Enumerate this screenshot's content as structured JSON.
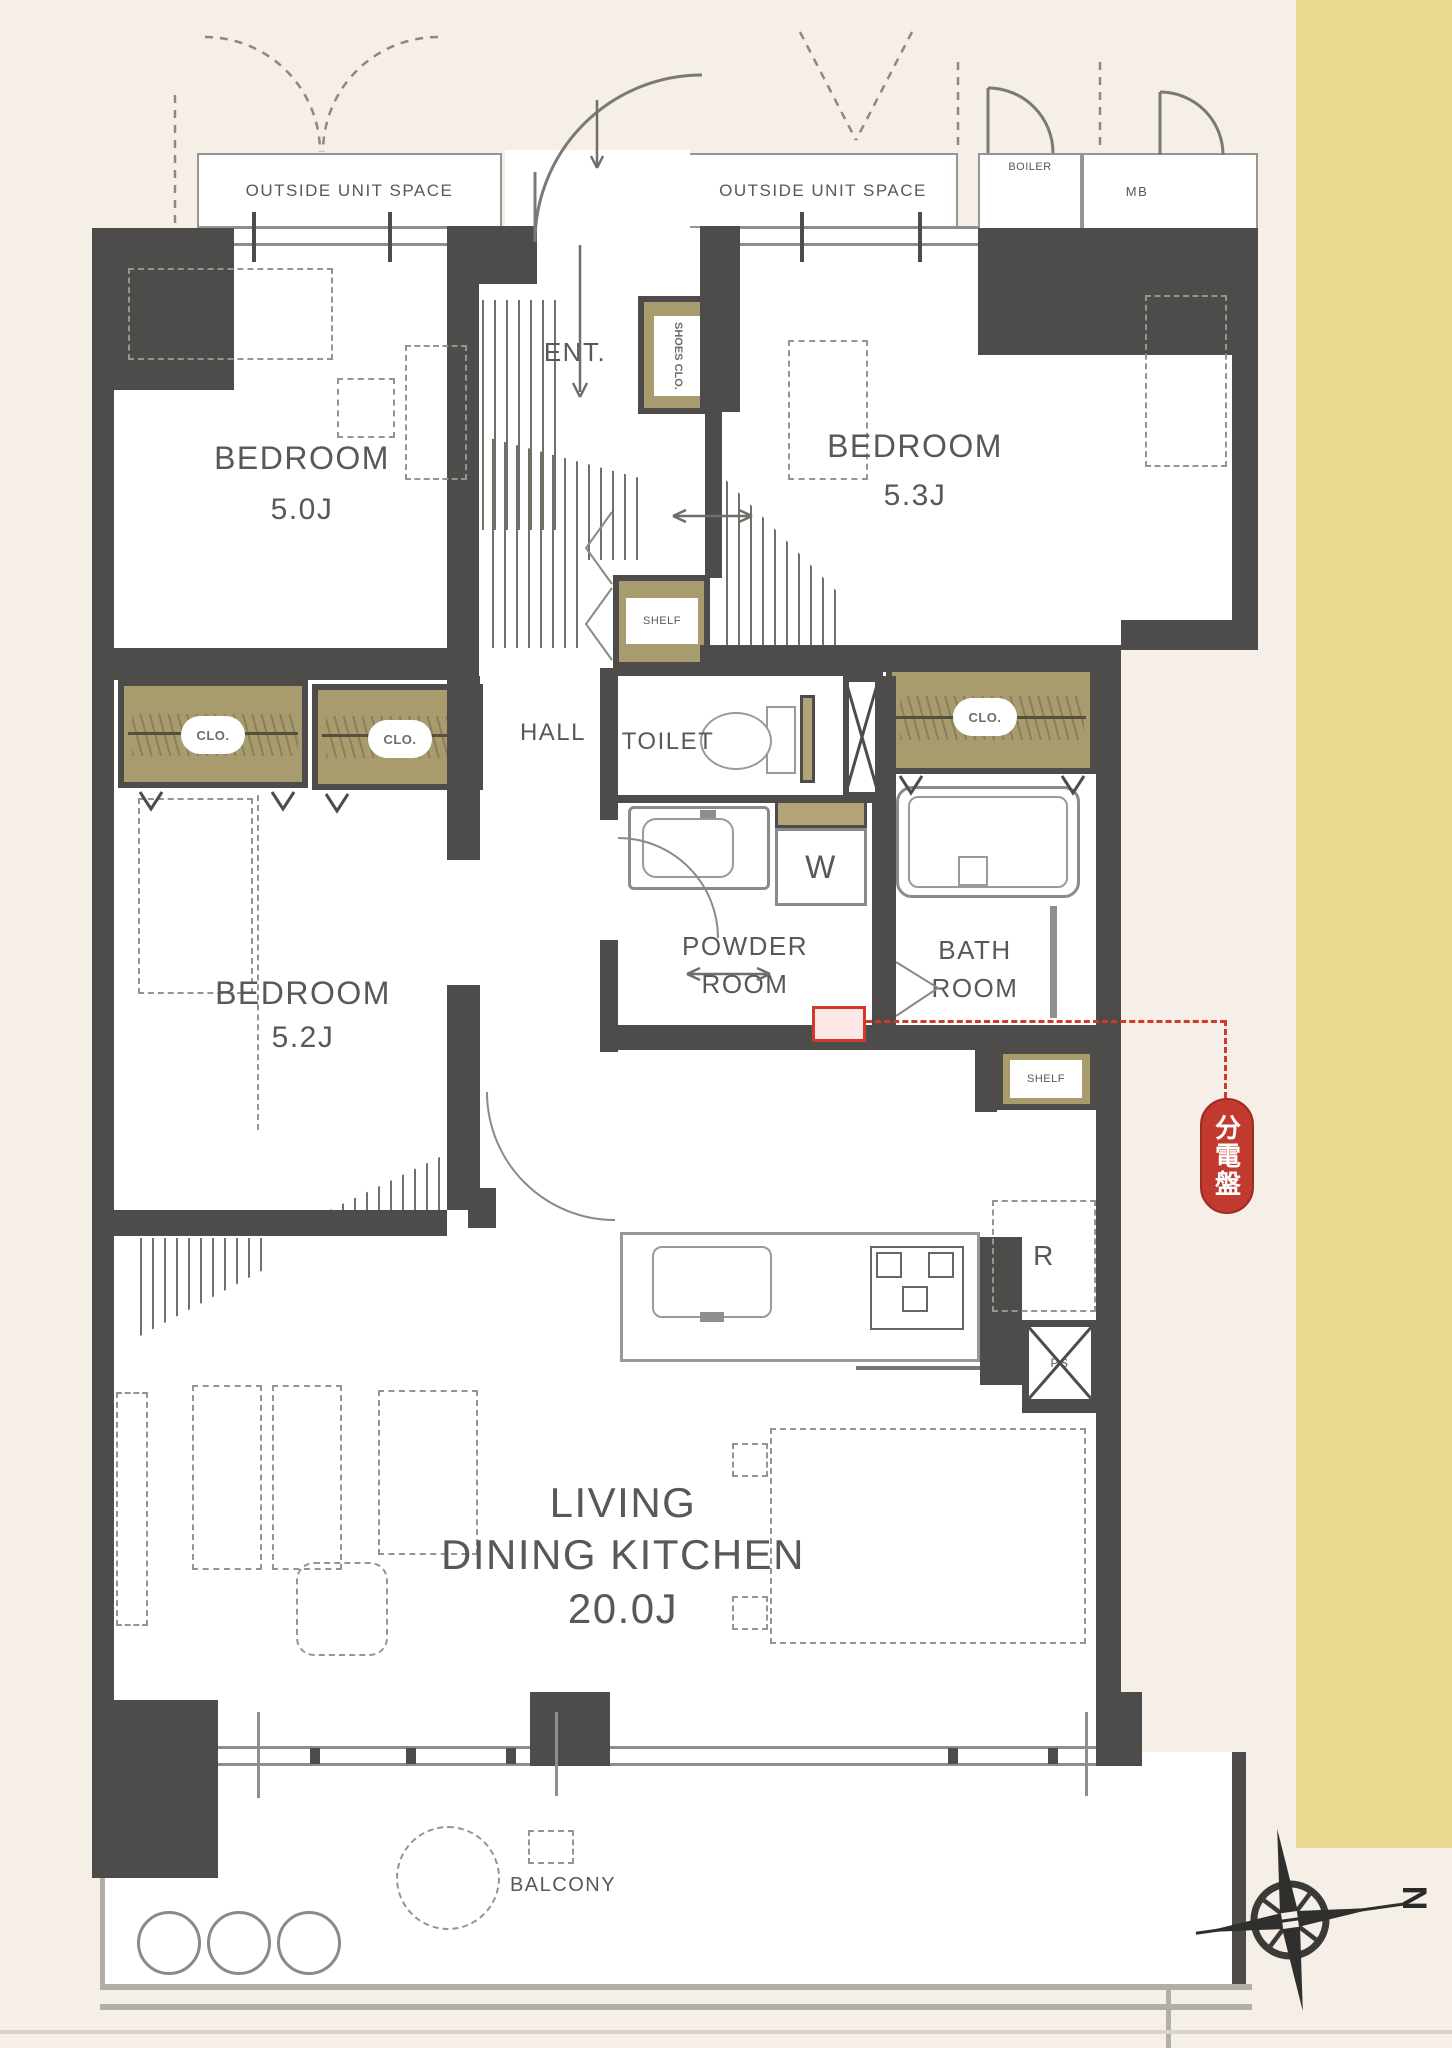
{
  "labels": {
    "outside_unit_space": "OUTSIDE UNIT SPACE",
    "boiler": "BOILER",
    "meter_box": "MB",
    "entrance": "ENT.",
    "shoes_closet": "SHOES CLO.",
    "hall": "HALL",
    "toilet": "TOILET",
    "powder_line1": "POWDER",
    "powder_line2": "ROOM",
    "bath_line1": "BATH",
    "bath_line2": "ROOM",
    "closet": "CLO.",
    "shelf": "SHELF",
    "washing_machine": "W",
    "refrigerator": "R",
    "pipe_space": "PS",
    "balcony": "BALCONY",
    "compass_north": "N",
    "distribution_board_stamp": "分電盤"
  },
  "rooms": {
    "bedroom_1": {
      "name": "BEDROOM",
      "area": "5.0J"
    },
    "bedroom_2": {
      "name": "BEDROOM",
      "area": "5.3J"
    },
    "bedroom_3": {
      "name": "BEDROOM",
      "area": "5.2J"
    },
    "ldk": {
      "line1": "LIVING",
      "line2": "DINING KITCHEN",
      "area": "20.0J"
    }
  },
  "colors": {
    "wall": "#4d4c4a",
    "closet_fill": "#a89b6e",
    "accent_red": "#c8392e",
    "background": "#f5efe8",
    "side_band": "#e9da90"
  }
}
